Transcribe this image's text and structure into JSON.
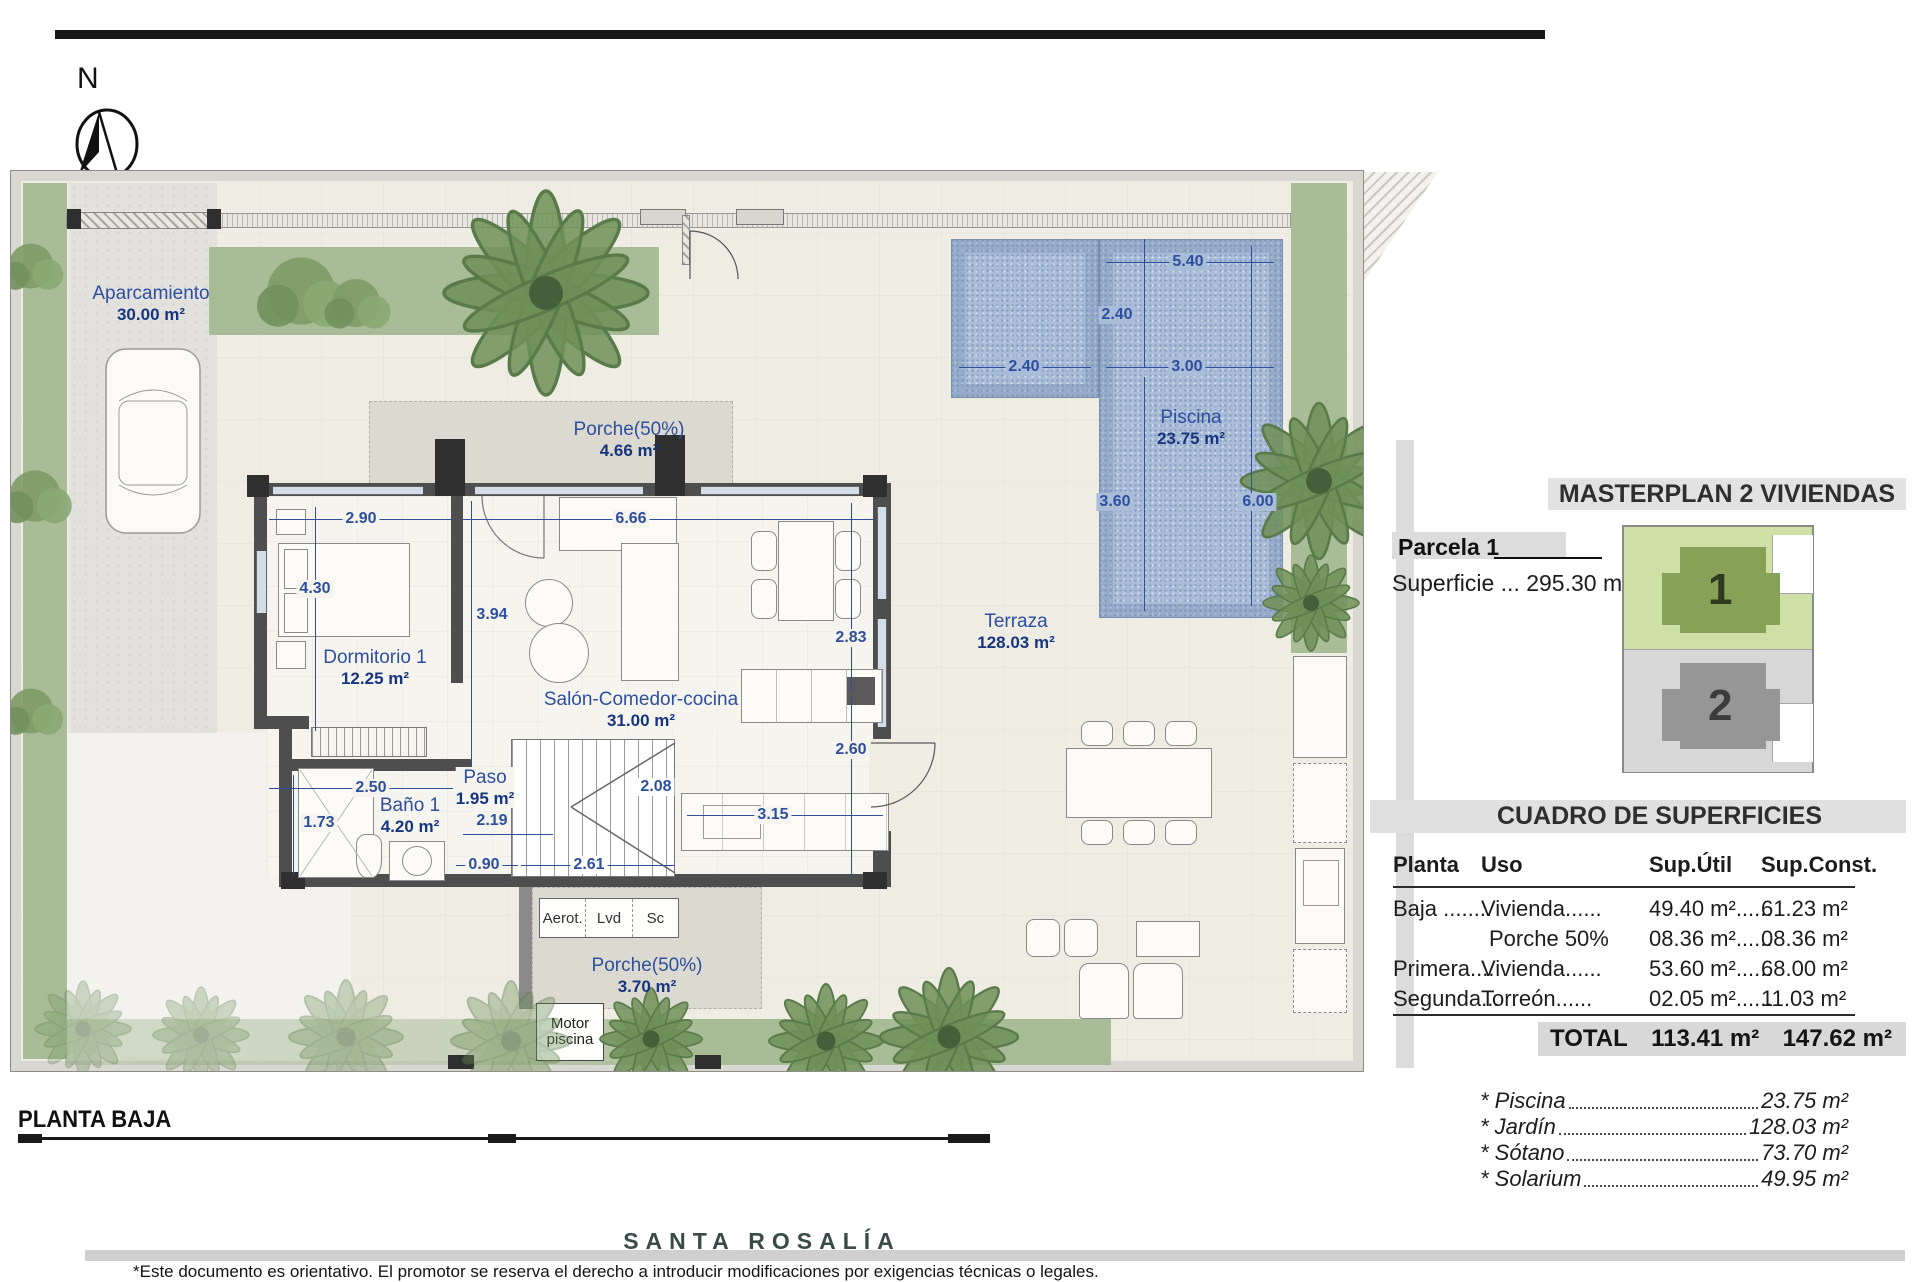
{
  "compass": {
    "north": "N"
  },
  "plan": {
    "title": "PLANTA BAJA",
    "rooms": [
      {
        "name": "Aparcamiento",
        "area": "30.00 m²"
      },
      {
        "name": "Porche(50%)",
        "area": "4.66 m²"
      },
      {
        "name": "Dormitorio 1",
        "area": "12.25 m²"
      },
      {
        "name": "Salón-Comedor-cocina",
        "area": "31.00 m²"
      },
      {
        "name": "Baño 1",
        "area": "4.20 m²"
      },
      {
        "name": "Paso",
        "area": "1.95 m²"
      },
      {
        "name": "Terraza",
        "area": "128.03 m²"
      },
      {
        "name": "Piscina",
        "area": "23.75 m²"
      },
      {
        "name": "Porche(50%)",
        "area": "3.70 m²"
      }
    ],
    "dims": {
      "d290": "2.90",
      "d666": "6.66",
      "d430": "4.30",
      "d394": "3.94",
      "d283": "2.83",
      "d260": "2.60",
      "d315": "3.15",
      "d250": "2.50",
      "d173": "1.73",
      "d219": "2.19",
      "d090": "0.90",
      "d261": "2.61",
      "d208": "2.08",
      "d540": "5.40",
      "d240a": "2.40",
      "d240b": "2.40",
      "d300": "3.00",
      "d360": "3.60",
      "d600": "6.00"
    },
    "utilities": {
      "aerot": "Aerot.",
      "lvd": "Lvd",
      "sc": "Sc",
      "motor": "Motor piscina"
    }
  },
  "masterplan": {
    "title": "MASTERPLAN 2 VIVIENDAS",
    "parcel": "Parcela 1",
    "superficie": "Superficie ... 295.30 m²",
    "plot1": "1",
    "plot2": "2"
  },
  "surfaces": {
    "title": "CUADRO DE SUPERFICIES",
    "headers": [
      "Planta",
      "Uso",
      "Sup.Útil",
      "Sup.Const."
    ],
    "rows": [
      [
        "Baja ........",
        "Vivienda......",
        "49.40 m²......",
        "61.23 m²"
      ],
      [
        "",
        "Porche 50%",
        "08.36 m²......",
        "08.36 m²"
      ],
      [
        "Primera....",
        "Vivienda......",
        "53.60 m²......",
        "68.00 m²"
      ],
      [
        "Segunda...",
        "Torreón......",
        "02.05 m²......",
        "11.03 m²"
      ]
    ],
    "total_label": "TOTAL",
    "total_util": "113.41 m²",
    "total_const": "147.62 m²",
    "extras": [
      {
        "label": "* Piscina",
        "value": "23.75 m²"
      },
      {
        "label": "* Jardín",
        "value": "128.03 m²"
      },
      {
        "label": "* Sótano",
        "value": "73.70 m²"
      },
      {
        "label": "* Solarium",
        "value": "49.95 m²"
      }
    ]
  },
  "footer": {
    "brand": "SANTA ROSALÍA",
    "disclaimer": "*Este documento es orientativo. El promotor se reserva el derecho a introducir modificaciones por exigencias técnicas o legales."
  }
}
